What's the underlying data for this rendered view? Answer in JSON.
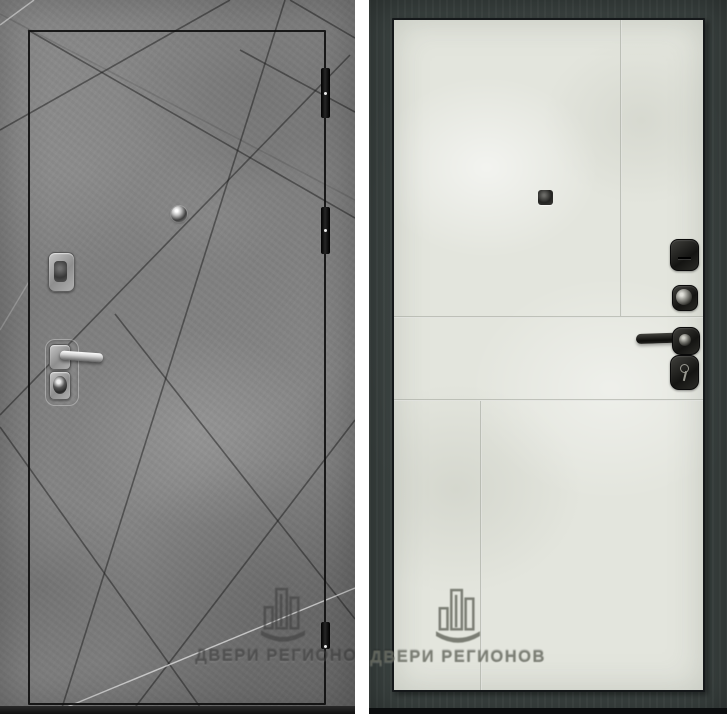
{
  "photo": {
    "watermark": {
      "text": "ДВЕРИ РЕГИОНОВ",
      "logo_icon": "buildings-bar-logo"
    },
    "left_door": {
      "finish_hex": "#828282",
      "outline_hex": "#141414",
      "hardware_hex": "#d6d6d6",
      "hinge_hex": "#0e0e0e"
    },
    "right_door": {
      "frame_hex": "#3b4341",
      "leaf_hex": "#e3e5dd",
      "hardware_hex": "#1c1c1a"
    }
  }
}
